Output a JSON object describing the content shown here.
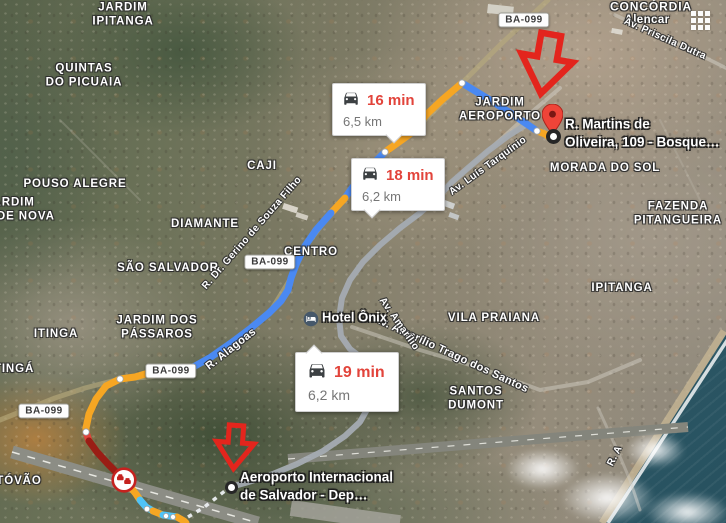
{
  "app": {
    "name": "maps-satellite-directions"
  },
  "bubbles": [
    {
      "time": "16 min",
      "distance": "6,5 km"
    },
    {
      "time": "18 min",
      "distance": "6,2 km"
    },
    {
      "time": "19 min",
      "distance": "6,2 km"
    }
  ],
  "markers": {
    "destination": {
      "label": "R. Martins de\nOliveira, 109 -  Bosque…"
    },
    "origin": {
      "label": "Aeroporto Internacional\nde Salvador - Dep…"
    }
  },
  "poi": {
    "hotel": {
      "label": "Hotel Ônix"
    }
  },
  "road_badges": {
    "name": "BA-099"
  },
  "place_labels": [
    {
      "text": "JARDIM\nIPITANGA"
    },
    {
      "text": "QUINTAS\nDO PICUAIA"
    },
    {
      "text": "POUSO ALEGRE"
    },
    {
      "text": "JARDIM\nCIDADE NOVA"
    },
    {
      "text": "CAJI"
    },
    {
      "text": "DIAMANTE"
    },
    {
      "text": "SÃO SALVADOR"
    },
    {
      "text": "JARDIM DOS\nPÁSSAROS"
    },
    {
      "text": "ITINGA"
    },
    {
      "text": "ITINGÁ"
    },
    {
      "text": "CENTRO"
    },
    {
      "text": "JARDIM\nAEROPORTO"
    },
    {
      "text": "MORADA DO SOL"
    },
    {
      "text": "FAZENDA\nPITANGUEIRA"
    },
    {
      "text": "IPITANGA"
    },
    {
      "text": "VILA PRAIANA"
    },
    {
      "text": "SANTOS\nDUMONT"
    },
    {
      "text": "CONCÓRDIA"
    },
    {
      "text": "Alencar"
    },
    {
      "text": "TÓVÃO"
    }
  ],
  "road_labels": [
    {
      "text": "Av. Priscila Dutra"
    },
    {
      "text": "Av. Luís Tarquínio"
    },
    {
      "text": "R. Dr. Gerino de Souza Filho"
    },
    {
      "text": "R. Alagoas"
    },
    {
      "text": "Av. Amarílio Trago dos Santos"
    },
    {
      "text": "Av. Amarílio"
    },
    {
      "text": "R. A"
    }
  ],
  "colors": {
    "route_blue": "#4a89f2",
    "route_cyan": "#4fc3f7",
    "route_orange": "#f6a623",
    "route_red": "#e2443b",
    "route_dark_red": "#9a1d15",
    "alt_route_grey": "#a4abb2",
    "time_text_red": "#e2443b",
    "annotation_arrow_red": "#e3251d"
  }
}
